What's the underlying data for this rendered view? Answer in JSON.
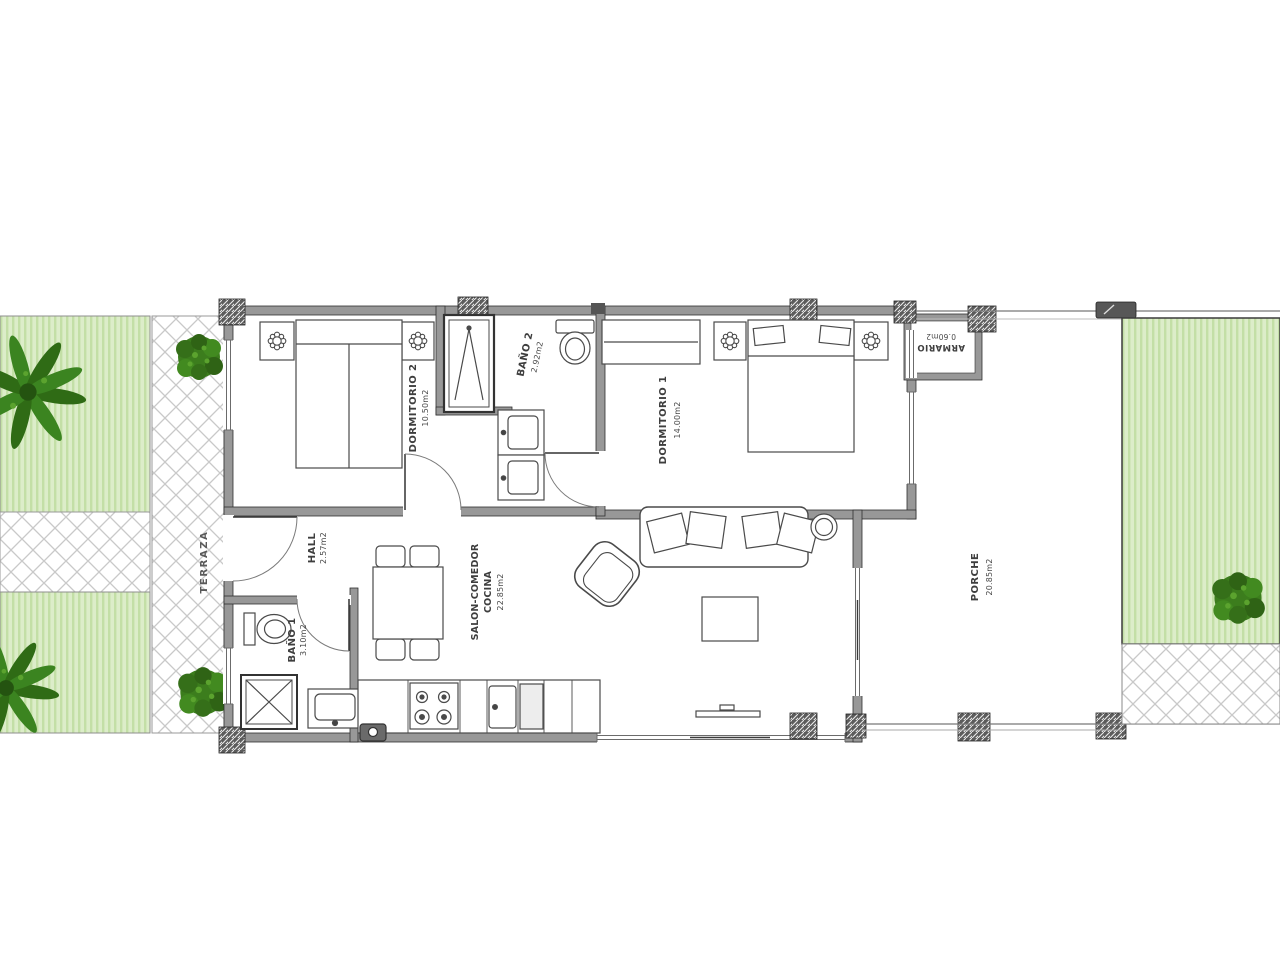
{
  "rooms": {
    "terraza": {
      "name": "TERRAZA"
    },
    "dormitorio2": {
      "name": "DORMITORIO 2",
      "area": "10.50m2"
    },
    "bano2": {
      "name": "BAÑO 2",
      "area": "2.92m2"
    },
    "dormitorio1": {
      "name": "DORMITORIO 1",
      "area": "14.00m2"
    },
    "armario": {
      "name": "ARMARIO",
      "area": "0.60m2"
    },
    "hall": {
      "name": "HALL",
      "area": "2.57m2"
    },
    "bano1": {
      "name": "BAÑO 1",
      "area": "3.10m2"
    },
    "salon": {
      "name": "SALON-COMEDOR",
      "name2": "COCINA",
      "area": "22.85m2"
    },
    "porche": {
      "name": "PORCHE",
      "area": "20.85m2"
    }
  },
  "colors": {
    "garden_fill": "#dcedc9",
    "garden_stripe": "#c3dfa6",
    "lattice_line": "#c9c9c9",
    "wall_fill": "#989898",
    "wall_edge": "#2f2f2f",
    "furniture_line": "#4a4a4a",
    "tree_dark": "#2f6b15",
    "tree_light": "#4f9727",
    "label_text": "#3e3e3e"
  }
}
